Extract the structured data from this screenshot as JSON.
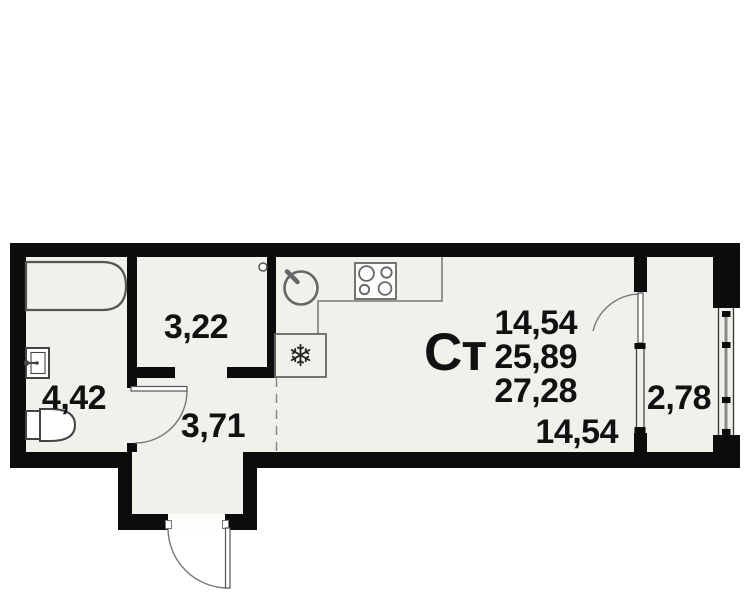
{
  "title": "Ст",
  "areas": {
    "bathroom": "4,42",
    "closet": "3,22",
    "hall": "3,71",
    "balcony": "2,78",
    "living_room": "14,54",
    "stats": [
      "14,54",
      "25,89",
      "27,28"
    ]
  },
  "icons": {
    "fridge_snowflake": "❄"
  },
  "colors": {
    "wall": "#0c0c0c",
    "floor": "#f2f0ea",
    "fixture_stroke": "#555555",
    "counter_stroke": "#888888",
    "text": "#111111"
  }
}
